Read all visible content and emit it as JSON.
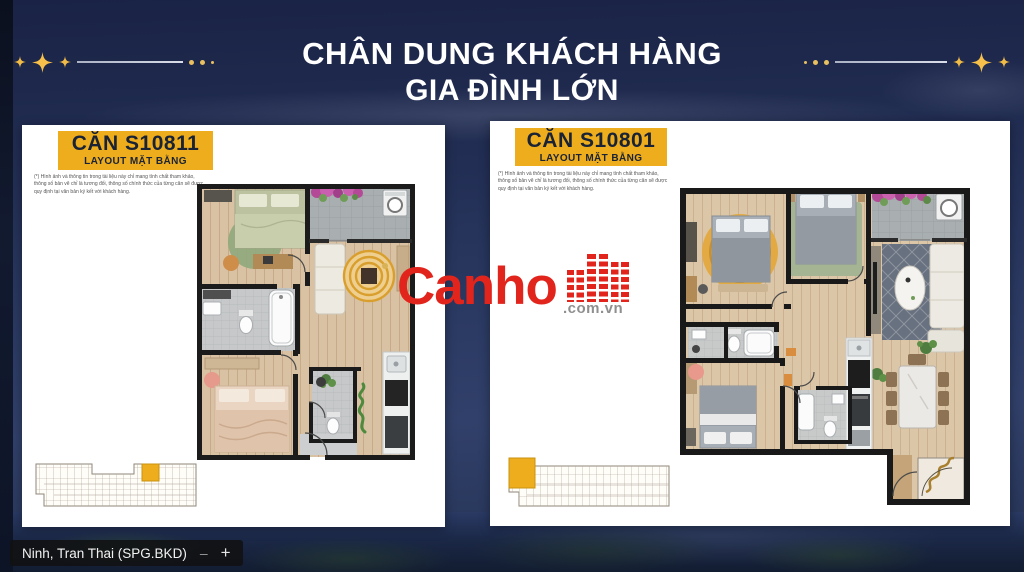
{
  "header": {
    "title_line_1": "CHÂN DUNG KHÁCH HÀNG",
    "title_line_2": "GIA ĐÌNH LỚN",
    "text_color": "#ffffff",
    "star_color": "#f2bb45"
  },
  "watermark": {
    "brand": "Canho",
    "suffix": ".com.vn",
    "brand_color": "#e2251c",
    "suffix_color": "#8f8f8f",
    "icon": "buildings-icon"
  },
  "cards": [
    {
      "unit_code": "CĂN S10811",
      "layout_label": "LAYOUT MẶT BẰNG",
      "badge_color": "#eead1d",
      "badge_text_color": "#1a2335",
      "disclaimer_lines": [
        "(*) Hình ảnh và thông tin trong tài liệu này chỉ mang tính chất tham khảo,",
        "thông số bản vẽ chỉ là tương đối, thông số chính thức của từng căn sẽ được",
        "quy định tại văn bản ký kết với khách hàng."
      ],
      "floor_plan": {
        "unit": "S10811",
        "rooms": [
          "bedroom-1",
          "bedroom-2",
          "bathroom-1",
          "bathroom-2",
          "living-room",
          "kitchen",
          "balcony-laundry",
          "entry"
        ]
      },
      "key_plan": {
        "highlight_color": "#eead1d",
        "highlight_position": "right-of-center"
      }
    },
    {
      "unit_code": "CĂN S10801",
      "layout_label": "LAYOUT MẶT BẰNG",
      "badge_color": "#eead1d",
      "badge_text_color": "#1a2335",
      "disclaimer_lines": [
        "(*) Hình ảnh và thông tin trong tài liệu này chỉ mang tính chất tham khảo,",
        "thông số bản vẽ chỉ là tương đối, thông số chính thức của từng căn sẽ được",
        "quy định tại văn bản ký kết với khách hàng."
      ],
      "floor_plan": {
        "unit": "S10801",
        "rooms": [
          "master-bedroom",
          "bedroom-2",
          "bedroom-3",
          "bathroom-1",
          "bathroom-2",
          "living-room",
          "dining-area",
          "kitchen",
          "balcony-laundry",
          "entry-hall"
        ]
      },
      "key_plan": {
        "highlight_color": "#eead1d",
        "highlight_position": "far-left"
      }
    }
  ],
  "presenter_bar": {
    "label": "Ninh, Tran Thai (SPG.BKD)",
    "zoom_out_glyph": "–",
    "zoom_in_glyph": "+"
  },
  "colors": {
    "background_navy": "#233056",
    "badge_gold": "#eead1d",
    "canho_red": "#e2251c",
    "card_white": "#ffffff"
  }
}
